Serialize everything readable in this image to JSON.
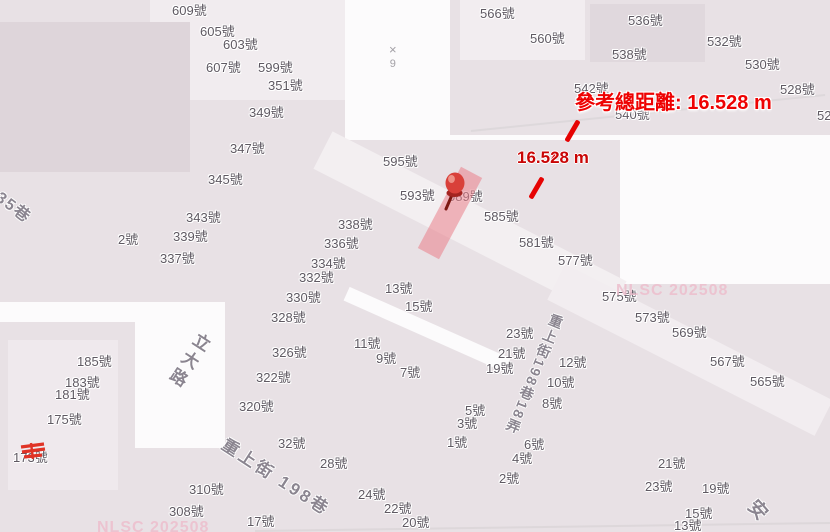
{
  "map": {
    "colors": {
      "block": "#e8e1e5",
      "block_light": "#f2edf0",
      "block_dark": "#ded5da",
      "road": "#fcfbfc",
      "label_text": "#5f5962",
      "street_text": "#8b8590",
      "measure_red": "#e60303",
      "highlight_pink": "#ea808b",
      "watermark_pink": "#edbecd"
    },
    "elevation_marker": {
      "symbol": "×",
      "value": "9"
    },
    "watermarks": {
      "right": "NLSC 202508",
      "bottom_left": "NLSC 202508"
    }
  },
  "measurement": {
    "total_label": "參考總距離: 16.528 m",
    "segment_label": "16.528 m"
  },
  "street_labels": [
    {
      "t": "35巷",
      "x": 2,
      "y": 190,
      "rot": 37,
      "fs": 16,
      "ls": 2,
      "vert": false
    },
    {
      "t": "立大路",
      "x": 198,
      "y": 329,
      "rot": 33,
      "fs": 17,
      "ls": 4,
      "vert": true
    },
    {
      "t": "重上街 198巷",
      "x": 228,
      "y": 436,
      "rot": 33,
      "fs": 17,
      "ls": 3,
      "vert": false
    },
    {
      "t": "重上街198巷18弄",
      "x": 552,
      "y": 312,
      "rot": 22,
      "fs": 14,
      "ls": 2,
      "vert": true
    },
    {
      "t": "安",
      "x": 758,
      "y": 497,
      "rot": 48,
      "fs": 19,
      "ls": 0,
      "vert": false
    }
  ],
  "address_labels": [
    {
      "t": "609號",
      "x": 172,
      "y": 4
    },
    {
      "t": "605號",
      "x": 200,
      "y": 25
    },
    {
      "t": "603號",
      "x": 223,
      "y": 38
    },
    {
      "t": "607號",
      "x": 206,
      "y": 61
    },
    {
      "t": "599號",
      "x": 258,
      "y": 61
    },
    {
      "t": "351號",
      "x": 268,
      "y": 79
    },
    {
      "t": "349號",
      "x": 249,
      "y": 106
    },
    {
      "t": "347號",
      "x": 230,
      "y": 142
    },
    {
      "t": "345號",
      "x": 208,
      "y": 173
    },
    {
      "t": "343號",
      "x": 186,
      "y": 211
    },
    {
      "t": "2號",
      "x": 118,
      "y": 233
    },
    {
      "t": "339號",
      "x": 173,
      "y": 230
    },
    {
      "t": "337號",
      "x": 160,
      "y": 252
    },
    {
      "t": "566號",
      "x": 480,
      "y": 7
    },
    {
      "t": "536號",
      "x": 628,
      "y": 14
    },
    {
      "t": "560號",
      "x": 530,
      "y": 32
    },
    {
      "t": "532號",
      "x": 707,
      "y": 35
    },
    {
      "t": "538號",
      "x": 612,
      "y": 48
    },
    {
      "t": "530號",
      "x": 745,
      "y": 58
    },
    {
      "t": "542號",
      "x": 574,
      "y": 82
    },
    {
      "t": "528號",
      "x": 780,
      "y": 83
    },
    {
      "t": "540號",
      "x": 615,
      "y": 108
    },
    {
      "t": "52",
      "x": 817,
      "y": 109
    },
    {
      "t": "595號",
      "x": 383,
      "y": 155
    },
    {
      "t": "593號",
      "x": 400,
      "y": 189
    },
    {
      "t": "589號",
      "x": 448,
      "y": 190
    },
    {
      "t": "585號",
      "x": 484,
      "y": 210
    },
    {
      "t": "581號",
      "x": 519,
      "y": 236
    },
    {
      "t": "577號",
      "x": 558,
      "y": 254
    },
    {
      "t": "338號",
      "x": 338,
      "y": 218
    },
    {
      "t": "336號",
      "x": 324,
      "y": 237
    },
    {
      "t": "334號",
      "x": 311,
      "y": 257
    },
    {
      "t": "332號",
      "x": 299,
      "y": 271
    },
    {
      "t": "330號",
      "x": 286,
      "y": 291
    },
    {
      "t": "328號",
      "x": 271,
      "y": 311
    },
    {
      "t": "326號",
      "x": 272,
      "y": 346
    },
    {
      "t": "322號",
      "x": 256,
      "y": 371
    },
    {
      "t": "320號",
      "x": 239,
      "y": 400
    },
    {
      "t": "13號",
      "x": 385,
      "y": 282
    },
    {
      "t": "15號",
      "x": 405,
      "y": 300
    },
    {
      "t": "11號",
      "x": 354,
      "y": 337
    },
    {
      "t": "9號",
      "x": 376,
      "y": 352
    },
    {
      "t": "7號",
      "x": 400,
      "y": 366
    },
    {
      "t": "23號",
      "x": 506,
      "y": 327
    },
    {
      "t": "21號",
      "x": 498,
      "y": 347
    },
    {
      "t": "19號",
      "x": 486,
      "y": 362
    },
    {
      "t": "5號",
      "x": 465,
      "y": 404
    },
    {
      "t": "3號",
      "x": 457,
      "y": 417
    },
    {
      "t": "1號",
      "x": 447,
      "y": 436
    },
    {
      "t": "32號",
      "x": 278,
      "y": 437
    },
    {
      "t": "28號",
      "x": 320,
      "y": 457
    },
    {
      "t": "24號",
      "x": 358,
      "y": 488
    },
    {
      "t": "22號",
      "x": 384,
      "y": 502
    },
    {
      "t": "20號",
      "x": 402,
      "y": 516
    },
    {
      "t": "12號",
      "x": 559,
      "y": 356
    },
    {
      "t": "10號",
      "x": 547,
      "y": 376
    },
    {
      "t": "8號",
      "x": 542,
      "y": 397
    },
    {
      "t": "6號",
      "x": 524,
      "y": 438
    },
    {
      "t": "4號",
      "x": 512,
      "y": 452
    },
    {
      "t": "2號",
      "x": 499,
      "y": 472
    },
    {
      "t": "575號",
      "x": 602,
      "y": 290
    },
    {
      "t": "573號",
      "x": 635,
      "y": 311
    },
    {
      "t": "569號",
      "x": 672,
      "y": 326
    },
    {
      "t": "567號",
      "x": 710,
      "y": 355
    },
    {
      "t": "565號",
      "x": 750,
      "y": 375
    },
    {
      "t": "21號",
      "x": 658,
      "y": 457
    },
    {
      "t": "23號",
      "x": 645,
      "y": 480
    },
    {
      "t": "19號",
      "x": 702,
      "y": 482
    },
    {
      "t": "15號",
      "x": 685,
      "y": 507
    },
    {
      "t": "13號",
      "x": 674,
      "y": 519
    },
    {
      "t": "185號",
      "x": 77,
      "y": 355
    },
    {
      "t": "183號",
      "x": 65,
      "y": 376
    },
    {
      "t": "181號",
      "x": 55,
      "y": 388
    },
    {
      "t": "175號",
      "x": 47,
      "y": 413
    },
    {
      "t": "173號",
      "x": 13,
      "y": 451
    },
    {
      "t": "310號",
      "x": 189,
      "y": 483
    },
    {
      "t": "308號",
      "x": 169,
      "y": 505
    },
    {
      "t": "17號",
      "x": 247,
      "y": 515
    }
  ]
}
